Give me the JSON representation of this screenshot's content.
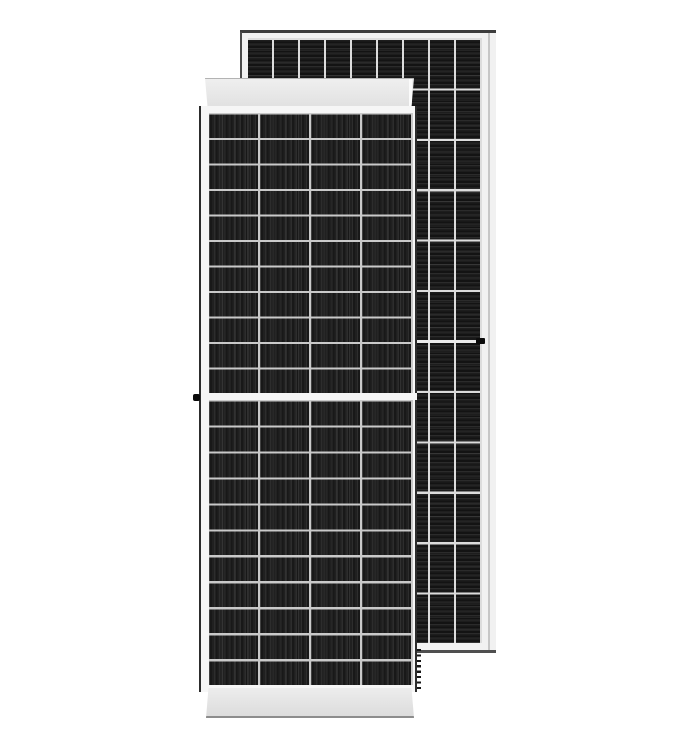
{
  "image": {
    "kind": "product-photo",
    "subject": "Two framed monocrystalline half-cut solar panels, front view overlapping back view",
    "background_color": "#ffffff"
  },
  "colors": {
    "background": "#ffffff",
    "cell_black": "#161616",
    "cell_stripe": "#2d2d2d",
    "front_divider": "#c9c9c9",
    "back_divider": "#dcdcdc",
    "front_frame": "#f6f6f6",
    "back_frame": "#f1f1f1",
    "front_edge": "#2c2c2c",
    "back_edge_top": "#3c3c3c",
    "back_edge_bottom": "#4f4f4f",
    "back_frame_line": "#c6c6c6",
    "band_gray": "#e8e8e8"
  },
  "panels": {
    "front": {
      "view": "front, portrait, half-cut cells with center gap",
      "columns": 4,
      "rows_upper": 11,
      "rows_lower": 11,
      "stripe_direction": "vertical",
      "features": [
        "top-frame-band",
        "bottom-frame-band",
        "grounding-dot-left-middle",
        "dashed-hidden-edge-right-bottom"
      ],
      "grid_upper": {
        "target": "front-upper",
        "cols": 4,
        "rows": 11,
        "width": 204,
        "height": 280.5,
        "divider": "#c9c9c9",
        "dividerW": 2.2,
        "stripe": {
          "dir": 90,
          "lite": "#2d2d2d",
          "base": "#181818",
          "mid": "#202020",
          "p1": 1.2,
          "p2": 3.2,
          "pitch": 5.1
        },
        "busbar": {
          "dir": 90,
          "color": "rgba(255,255,255,0.10)",
          "w": 1,
          "pitch": 12.75
        }
      },
      "grid_lower": {
        "target": "front-lower",
        "cols": 4,
        "rows": 11,
        "width": 204,
        "height": 285.5,
        "divider": "#c9c9c9",
        "dividerW": 2.2,
        "stripe": {
          "dir": 90,
          "lite": "#2d2d2d",
          "base": "#181818",
          "mid": "#202020",
          "p1": 1.2,
          "p2": 3.2,
          "pitch": 5.1
        },
        "busbar": {
          "dir": 90,
          "color": "rgba(255,255,255,0.10)",
          "w": 1,
          "pitch": 12.75
        }
      }
    },
    "back": {
      "view": "back, portrait, taller, center line with grounding tick on right frame",
      "columns": 9,
      "rows": 12,
      "stripe_direction": "horizontal",
      "features": [
        "thin-frame-all-around",
        "center-divider-line",
        "grounding-tick-right-middle"
      ],
      "grid": {
        "target": "back",
        "cols": 9,
        "rows": 12,
        "width": 234,
        "height": 605,
        "divider": "#dcdcdc",
        "dividerW": 2.1,
        "stripe": {
          "dir": 0,
          "lite": "#2b2b2b",
          "base": "#131313",
          "mid": "#1d1d1d",
          "p1": 1.1,
          "p2": 2.8,
          "pitch": 4.5
        },
        "busbar": {
          "dir": 0,
          "color": "rgba(255,255,255,0.05)",
          "w": 1,
          "pitch": 12.6
        }
      }
    }
  }
}
